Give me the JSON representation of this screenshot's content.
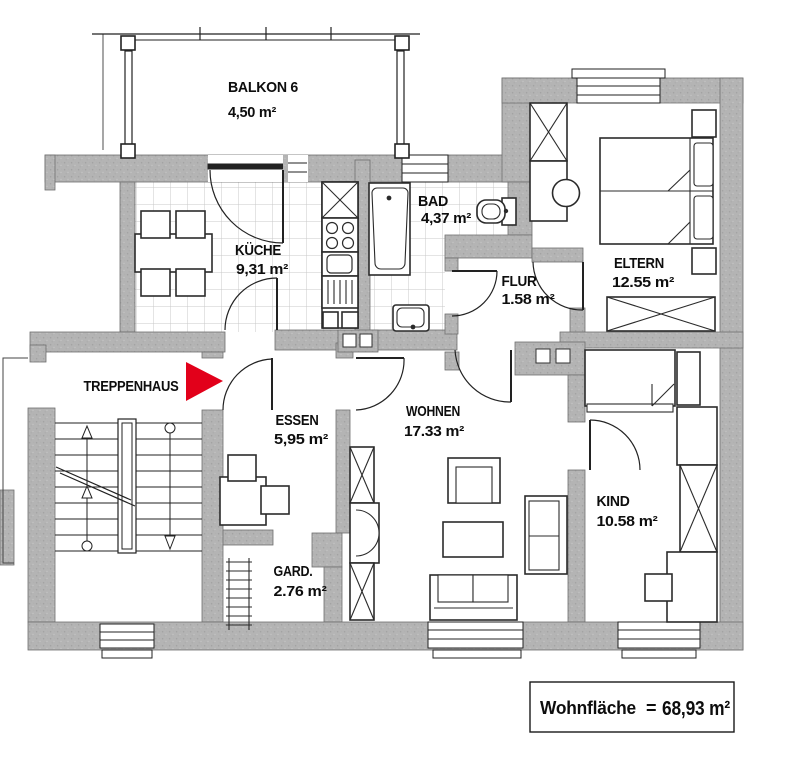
{
  "plan": {
    "balcony": {
      "name": "BALKON 6",
      "area": "4,50 m²"
    },
    "rooms": [
      {
        "id": "kueche",
        "name": "KÜCHE",
        "area": "9,31 m²"
      },
      {
        "id": "bad",
        "name": "BAD",
        "area": "4,37 m²"
      },
      {
        "id": "flur",
        "name": "FLUR",
        "area": "1.58 m²"
      },
      {
        "id": "eltern",
        "name": "ELTERN",
        "area": "12.55 m²"
      },
      {
        "id": "essen",
        "name": "ESSEN",
        "area": "5,95 m²"
      },
      {
        "id": "wohnen",
        "name": "WOHNEN",
        "area": "17.33 m²"
      },
      {
        "id": "kind",
        "name": "KIND",
        "area": "10.58 m²"
      },
      {
        "id": "garderobe",
        "name": "GARD.",
        "area": "2.76 m²"
      }
    ],
    "stairwell_label": "TREPPENHAUS",
    "total": {
      "label": "Wohnfläche",
      "equals": "=",
      "value": "68,93 m²"
    },
    "colors": {
      "wall": "#b4b4b4",
      "line": "#1a1a1a",
      "arrow_red": "#e2001a",
      "tile_line": "#c9c9c9"
    }
  }
}
